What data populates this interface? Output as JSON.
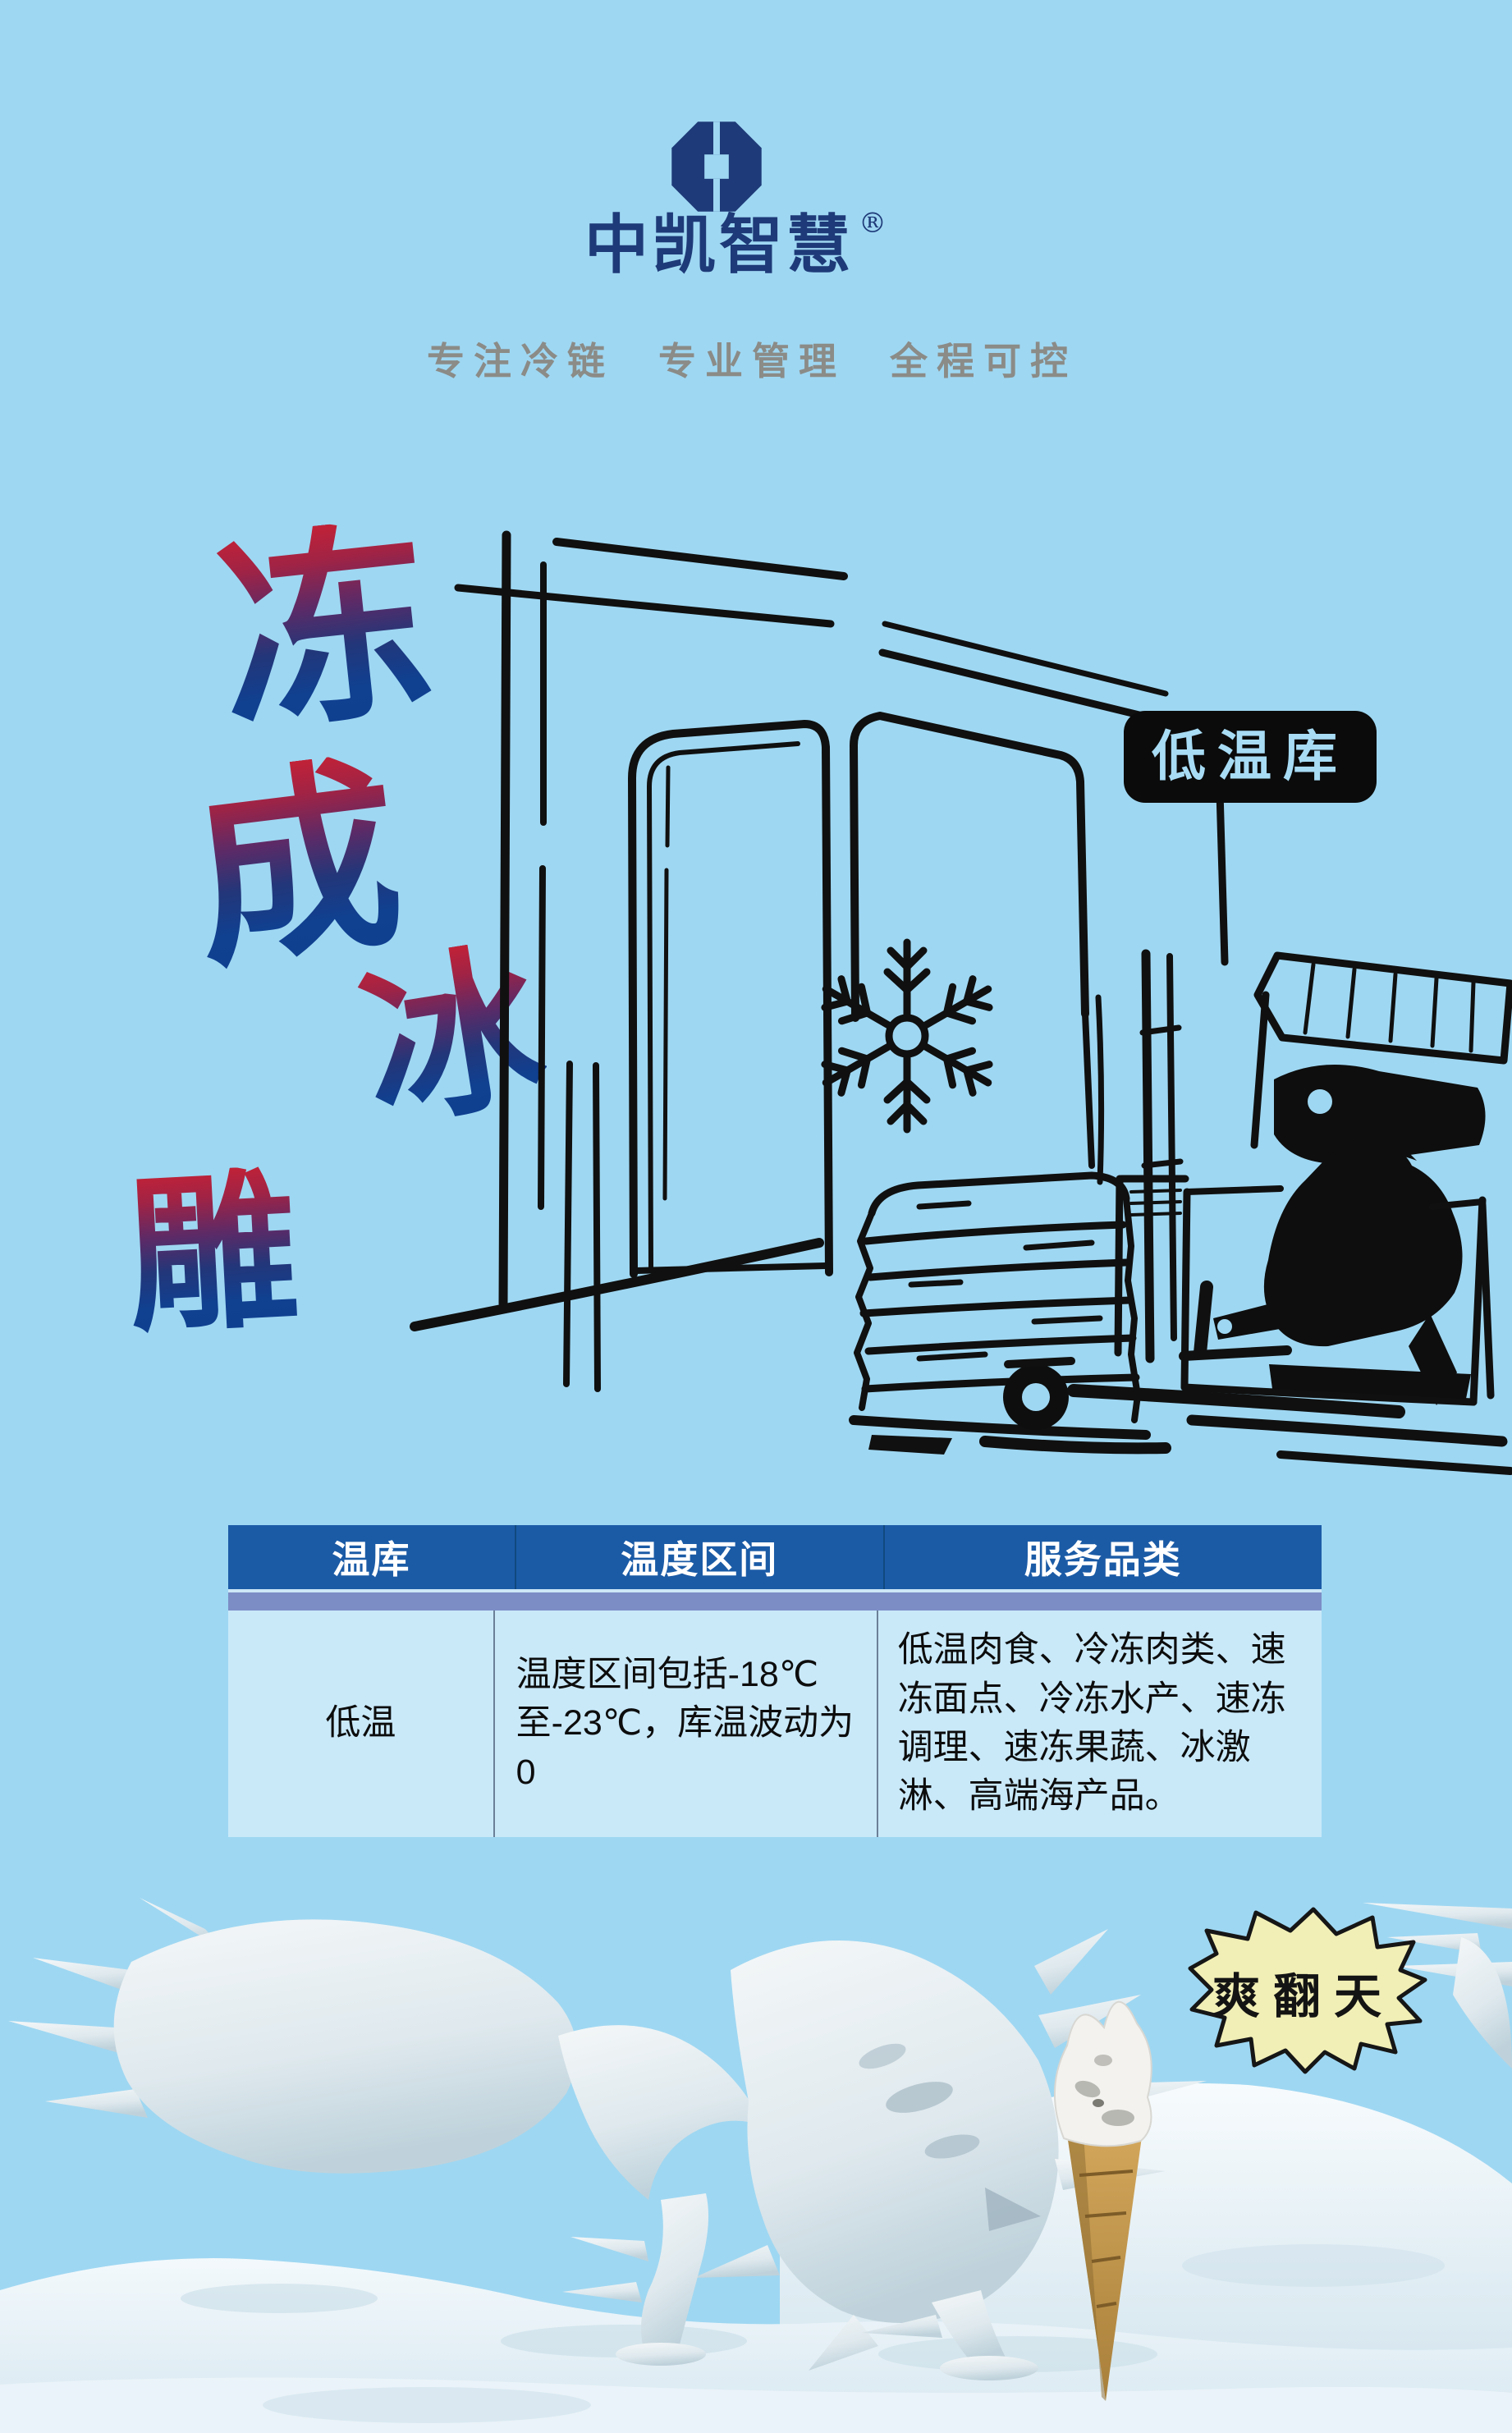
{
  "page": {
    "background": "#9ed7f2"
  },
  "header": {
    "brand": "中凯智慧",
    "registered": "®",
    "tagline": "专注冷链  专业管理  全程可控",
    "logo_color": "#1e3a78",
    "tagline_color": "#8b8b87"
  },
  "hero": {
    "chars": [
      "冻",
      "成",
      "冰",
      "雕"
    ],
    "gradient_top": "#c52236",
    "gradient_bottom": "#0e3f8f"
  },
  "scene": {
    "sign_label": "低温库",
    "sign_bg": "#0b0b0b",
    "sign_text_color": "#a8dcf5",
    "drawing_elements": [
      "cold-room-doors",
      "snowflake",
      "reach-truck-forklift",
      "driver",
      "stacked-sacks"
    ]
  },
  "table": {
    "headers": [
      "温库",
      "温度区间",
      "服务品类"
    ],
    "row": {
      "warehouse": "低温",
      "temperature_range": "温度区间包括-18℃至-23℃，库温波动为0",
      "categories": "低温肉食、冷冻肉类、速冻面点、冷冻水产、速冻调理、速冻果蔬、冰激淋、高端海产品。"
    },
    "header_bg": "#1b5ba6",
    "strip_color": "#7c8dc5",
    "body_bg": "#c9e9f9"
  },
  "footer": {
    "burst_label": "爽翻天",
    "burst_fill": "#f2efb6",
    "illustrations": [
      "frozen-rooster-ice-sculpture",
      "upside-down-ice-cream-cone",
      "snow-ground"
    ]
  }
}
